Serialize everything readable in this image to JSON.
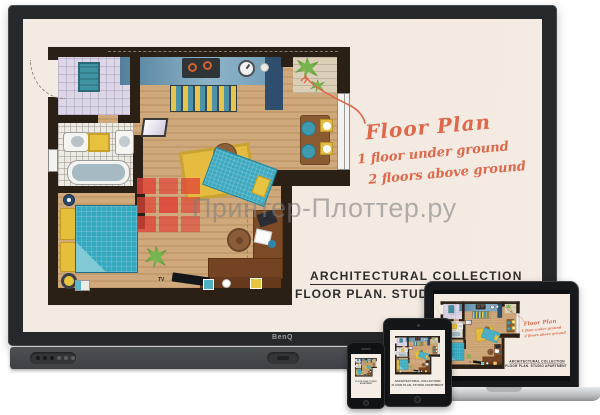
{
  "watermark": {
    "text": "Принтер-Плоттер.ру",
    "logo_color": "#e04338"
  },
  "display": {
    "brand": "BenQ"
  },
  "poster": {
    "annotation": {
      "title": "Floor Plan",
      "line1": "1 floor under ground",
      "line2": "2 floors above ground",
      "color": "#df674a"
    },
    "caption": {
      "line1": "ARCHITECTURAL COLLECTION",
      "line2": "FLOOR PLAN. STUDIO APARTMENT"
    },
    "labels": {
      "tv": "TV"
    }
  }
}
